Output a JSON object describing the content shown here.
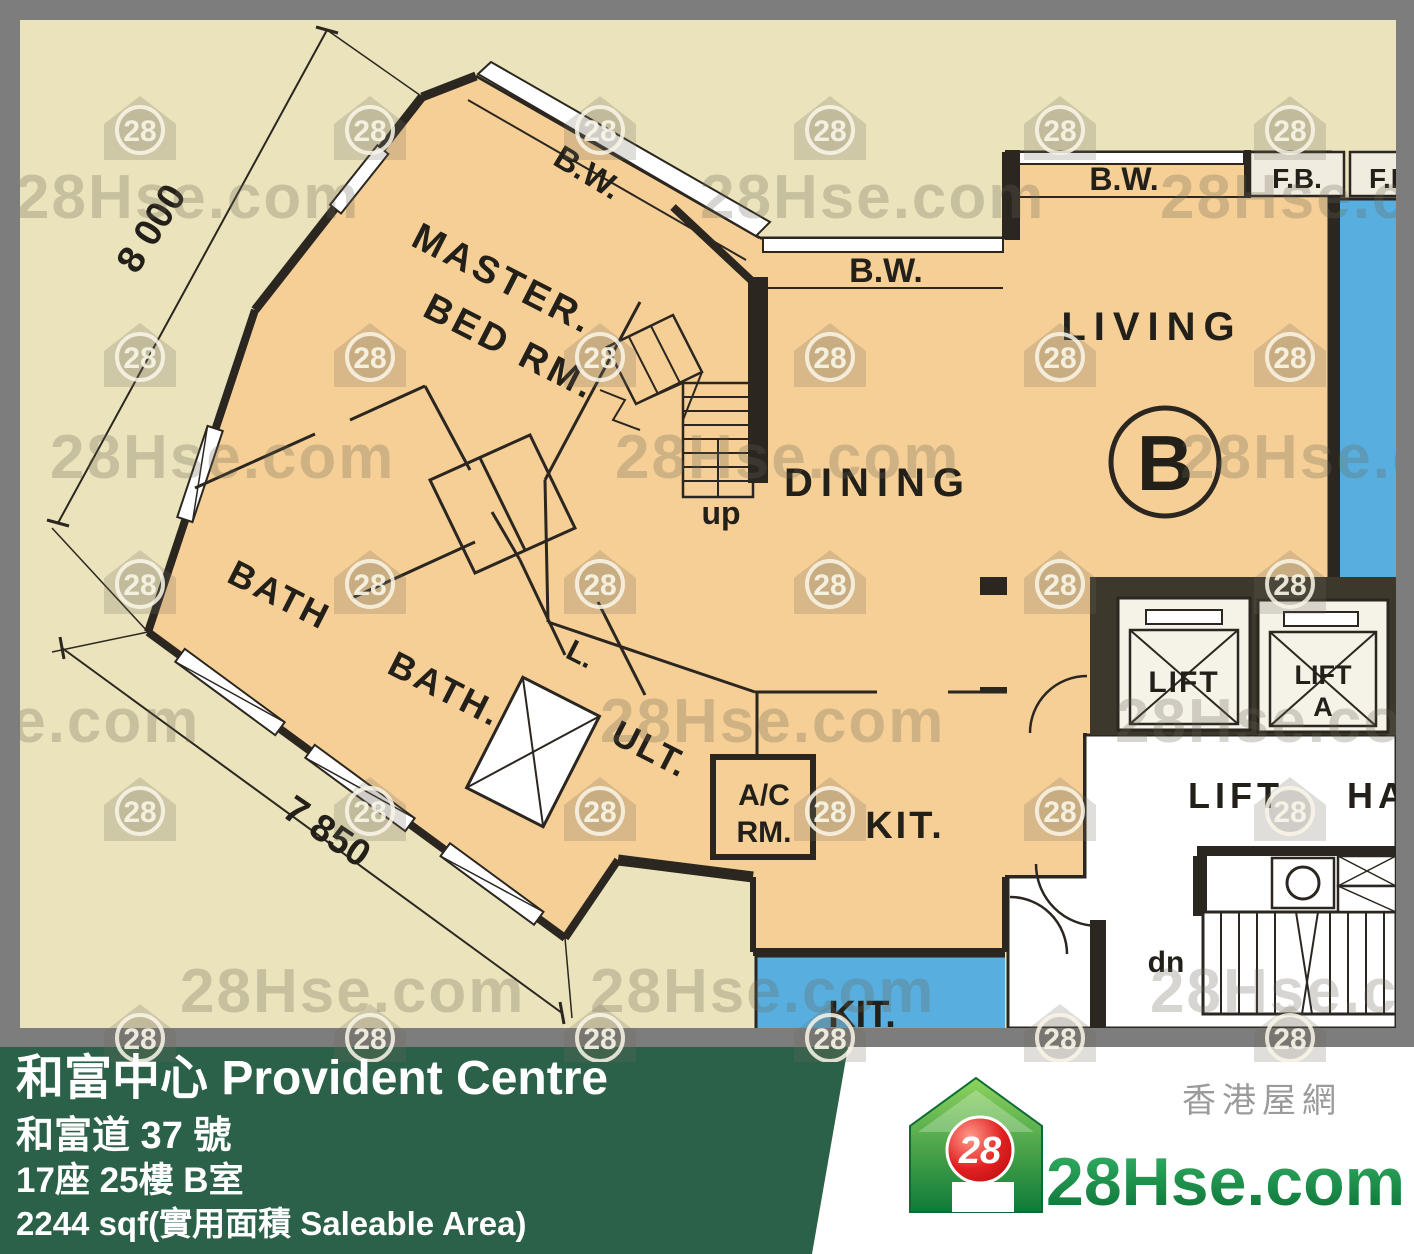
{
  "plan": {
    "dims": {
      "top": "8 000",
      "bottom": "7 850"
    },
    "labels": {
      "master1": "MASTER.",
      "master2": "BED RM.",
      "bath1": "BATH",
      "bath2": "BATH.",
      "closet": "L.",
      "utility": "ULT.",
      "ac1": "A/C",
      "ac2": "RM.",
      "kitchen": "KIT.",
      "dining": "DINING",
      "living": "LIVING",
      "unit": "B",
      "stairs_up": "up",
      "stairs_down": "dn",
      "lift1": "LIFT",
      "lift2_line1": "LIFT",
      "lift2_line2": "A",
      "hall1": "LIFT",
      "hall2": "HA",
      "bw": "B.W.",
      "fb1": "F.B.",
      "fb2": "F.B",
      "kit_adjacent": "KIT."
    }
  },
  "footer": {
    "title": "和富中心 Provident Centre",
    "address": "和富道 37 號",
    "unit": "17座 25樓 B室",
    "area": "2244 sqf(實用面積 Saleable Area)"
  },
  "logo": {
    "badge": "28",
    "brand": "28Hse.com",
    "tagline": "香港屋網"
  },
  "watermark": {
    "text": "28Hse.com",
    "badge": "28"
  },
  "colors": {
    "background_beige": "#eae3bb",
    "room_peach": "#f5cf96",
    "adjacent_blue": "#58aede",
    "wall_black": "#2b2720",
    "border_gray": "#7d7d7d",
    "bar_green": "#2b6148",
    "logo_green": "#14954c",
    "logo_red": "#d31616"
  }
}
